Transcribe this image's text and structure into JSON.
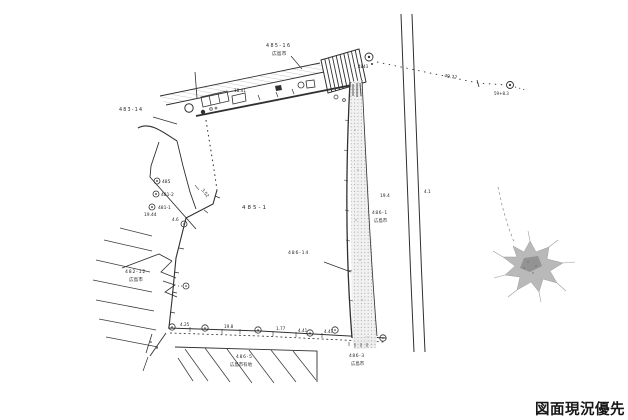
{
  "drawing": {
    "stamp": "図面現況優先",
    "lots": {
      "top": {
        "number": "485-16",
        "owner": "広島市"
      },
      "left": {
        "number": "483-14"
      },
      "lower_left": {
        "number": "482-12",
        "owner": "広島市"
      },
      "center": {
        "number": "485-1"
      },
      "strip": {
        "number": "486-14"
      },
      "strip_top": {
        "number": "486-1",
        "owner": "広島市"
      },
      "strip_bottom": {
        "number": "486-3",
        "owner": "広島市"
      },
      "bottom": {
        "number": "486-5",
        "owner": "広島市有地"
      }
    },
    "points": {
      "cluster": [
        "485",
        "481-2",
        "481-1"
      ],
      "cp_start": "4843",
      "cp_end": "59+8.3"
    },
    "measurements": {
      "main": "49.77",
      "left": "19.44",
      "slant": "3.52",
      "edge": "4.6",
      "building": "18.41",
      "bottom": [
        "4.25",
        "19.8",
        "1.77",
        "4.41",
        "4.47"
      ],
      "faint": [
        "19.4",
        "4.1"
      ]
    }
  }
}
